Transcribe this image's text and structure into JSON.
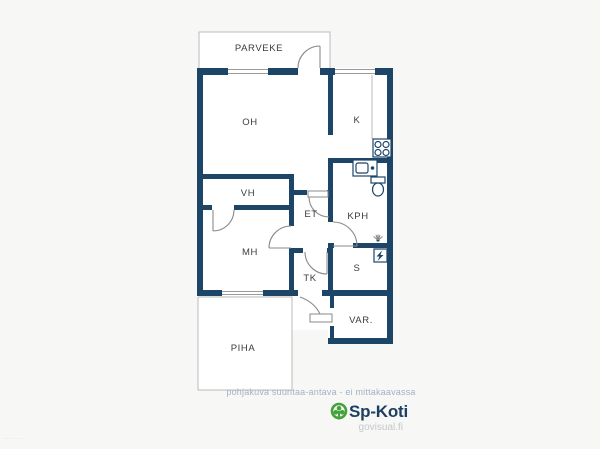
{
  "floorplan": {
    "rooms": {
      "parveke": "PARVEKE",
      "oh": "OH",
      "k": "K",
      "vh": "VH",
      "et": "ET",
      "kph": "KPH",
      "mh": "MH",
      "tk": "TK",
      "s": "S",
      "var": "VAR.",
      "piha": "PIHA"
    },
    "fixtures": [
      "stove-icon",
      "sink-icon",
      "toilet-icon",
      "shower-icon",
      "sauna-heater-icon"
    ],
    "colors": {
      "wall": "#1d4568",
      "background": "#f7f7f5",
      "room_fill": "#ffffff",
      "thin_line": "#bbbbbb",
      "door_line": "#8a8a8a",
      "label_text": "#3c3c3c"
    }
  },
  "footer": {
    "caption": "pohjakuva suuntaa-antava - ei mittakaavassa",
    "brand": "Sp-Koti",
    "site": "govisual.fi",
    "watermark": "······· ······",
    "colors": {
      "caption_text": "#a3b2c6",
      "brand_text": "#1e3f63",
      "site_text": "#c5c8cb",
      "logo_green": "#41a338"
    }
  }
}
